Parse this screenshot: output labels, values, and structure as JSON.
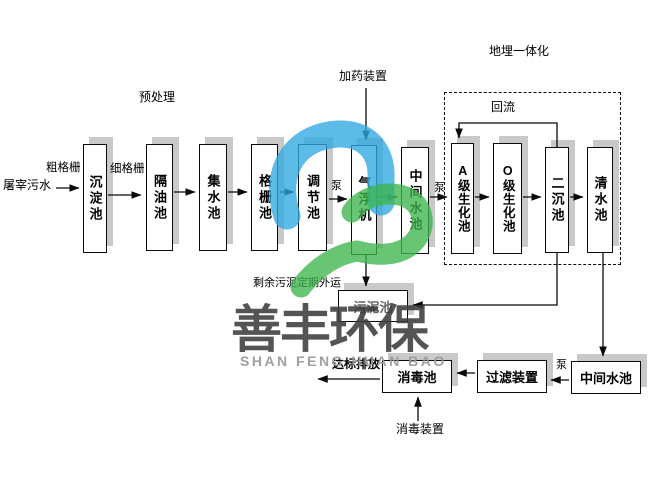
{
  "flow": {
    "influent": "屠宰污水",
    "coarse_screen": "粗格栅",
    "fine_screen": "细格栅",
    "pretreatment": "预处理",
    "dosing_device": "加药装置",
    "buried_integration": "地埋一体化",
    "reflux": "回流",
    "pump": "泵",
    "surplus_sludge": "剩余污泥定期外运",
    "discharge": "达标排放",
    "disinfection_device": "消毒装置",
    "tanks": {
      "sedimentation": "沉淀池",
      "oil_separation": "隔油池",
      "collecting": "集水池",
      "screen": "格栅池",
      "regulating": "调节池",
      "air_flotation": "气浮机",
      "intermediate_top": "中间水池",
      "a_bio": "A级生化池",
      "o_bio": "O级生化池",
      "secondary_sed": "二沉池",
      "clear_water": "清水池",
      "sludge": "污泥池",
      "disinfection": "消毒池",
      "filter": "过滤装置",
      "intermediate_bottom": "中间水池"
    }
  },
  "watermark": {
    "cn": "善丰环保",
    "en": "SHAN FENG HUAN BAO",
    "logo_blue": "#2fa8e1",
    "logo_green": "#3cb54d",
    "cn_color": "#3b3e3c",
    "en_color": "#9b9b9b"
  }
}
